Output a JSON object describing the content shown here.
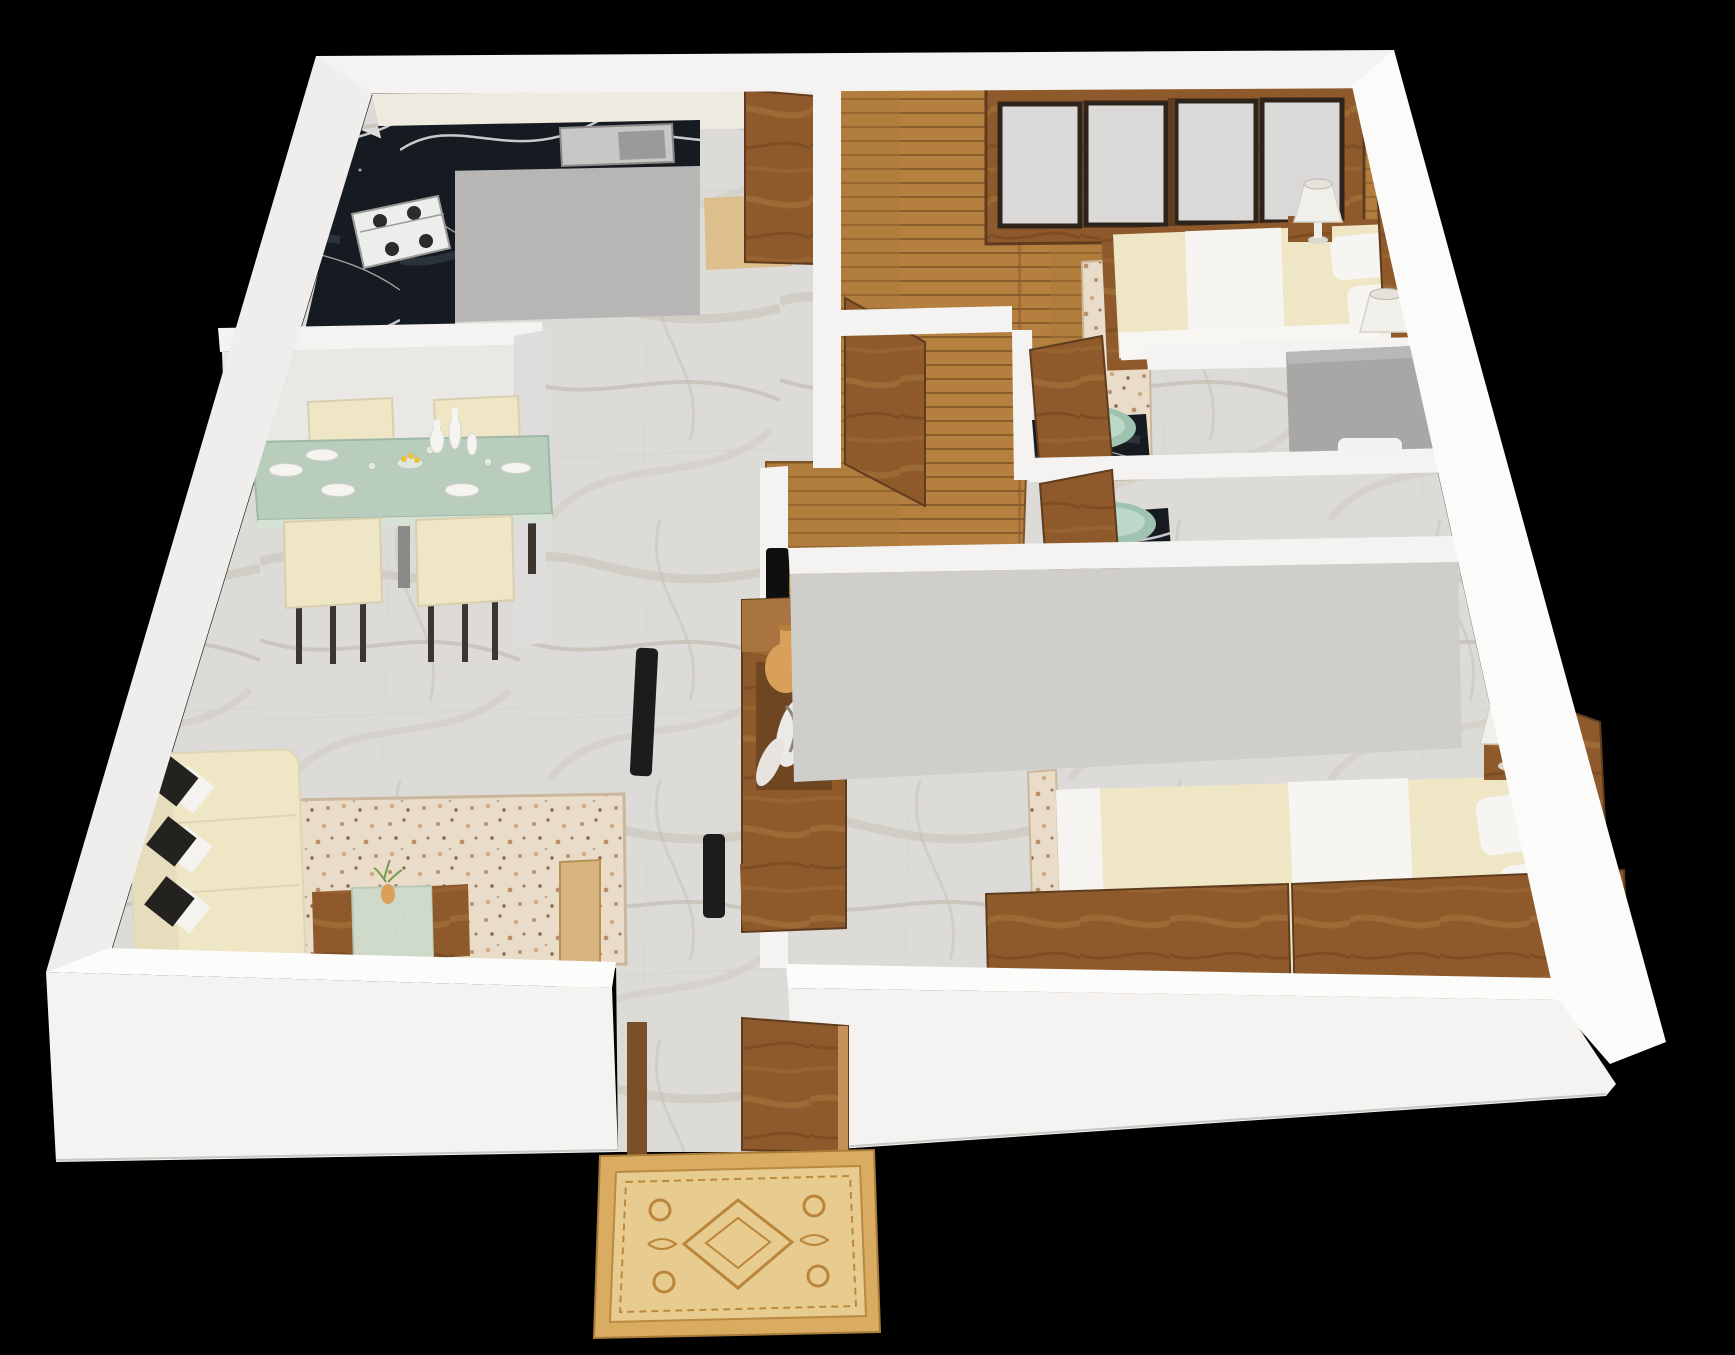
{
  "scene": {
    "title": "3d-apartment-floor-plan-render",
    "view": "isometric-top-down",
    "background": "#000000"
  },
  "colors": {
    "background": "#000000",
    "wallWhite": "#f4f3f1",
    "wallCap": "#fcfcfb",
    "wallFace": "#e9e8e5",
    "wallInner": "#dedddb",
    "wallGray": "#cfcecb",
    "kitchenBackWall": "#efeae0",
    "grayCabinet": "#b7b6b4",
    "shower": "#a8a7a5",
    "sinkSteel": "#c7c7c5",
    "sinkBasin": "#9a9a98",
    "stoveWhite": "#eceeec",
    "burnerBlack": "#2b2b2b",
    "cream": "#efe6c6",
    "creamShade": "#e6ddbd",
    "bedding": "#f6f5f1",
    "pillowBlack": "#23221f",
    "tableGlass": "#b9cdbc",
    "tableGlassEdge": "#9fb8a6",
    "coffeeGlass": "#cfdacc",
    "glassGreen": "#9fc3b1",
    "glassGreenLight": "#bcd8c8",
    "rugBeige": "#e7d8c4",
    "rugEdge": "#cbb79b",
    "matGold": "#d9ac62",
    "matField": "#e8cb8e",
    "matMotif": "#b9863b",
    "tanVase": "#d9a05a",
    "plantGreen": "#7a9a4e",
    "fruitYellow": "#e8c23a",
    "tvBlack": "#0f0f10",
    "speakerBlack": "#1c1c1c",
    "plateWhite": "#f5f4f0",
    "lampShade": "#f1efe9",
    "toiletWhite": "#f2f2f0",
    "legDark": "#3d3630",
    "lightWoodFloor": "#ddbf8e",
    "lightWoodDoor": "#d8b57e",
    "woodHighlight": "#c69059"
  },
  "rooms": [
    {
      "id": "kitchen",
      "furniture": [
        "l-shaped-black-marble-countertop",
        "gas-hob-4-burner",
        "kitchen-sink",
        "gray-base-cabinet",
        "open-wooden-door",
        "light-wood-floor-patch"
      ]
    },
    {
      "id": "dining-area",
      "furniture": [
        "green-glass-dining-table",
        "dining-chairs-x4",
        "dinner-plates-x5",
        "wine-glasses",
        "white-decor-vases-x3",
        "fruit-bowl"
      ]
    },
    {
      "id": "living-room",
      "furniture": [
        "cream-sofa",
        "black-white-cushions-x3",
        "beige-shag-rug",
        "glass-coffee-table",
        "small-vase-with-plant"
      ]
    },
    {
      "id": "hallway",
      "furniture": [
        "tv-panel",
        "floor-speakers-x2",
        "wooden-tv-shelf-unit",
        "tan-vase",
        "white-decor-vases",
        "wooden-low-cabinet",
        "entrance-open-door",
        "ornate-doormat"
      ]
    },
    {
      "id": "bedroom-1",
      "furniture": [
        "sliding-door-wardrobe",
        "double-bed-cream-duvet",
        "white-bed-runner",
        "pillows",
        "table-lamps-x2",
        "nightstand",
        "bedside-rug",
        "wood-plank-floor",
        "open-wooden-door"
      ]
    },
    {
      "id": "bathroom-1",
      "furniture": [
        "black-marble-vanity",
        "green-glass-vessel-sink",
        "faucet",
        "gray-shower-enclosure",
        "toilet",
        "open-wooden-door"
      ]
    },
    {
      "id": "bathroom-2",
      "furniture": [
        "black-marble-vanity",
        "green-glass-vessel-sink",
        "faucet",
        "open-wooden-door"
      ]
    },
    {
      "id": "bedroom-2",
      "furniture": [
        "wide-platform-bed",
        "cream-duvet",
        "white-bed-runner",
        "pillows-x2",
        "wooden-headboard",
        "nightstand",
        "table-lamp",
        "wood-footboard-panels",
        "bedside-rug"
      ]
    }
  ]
}
